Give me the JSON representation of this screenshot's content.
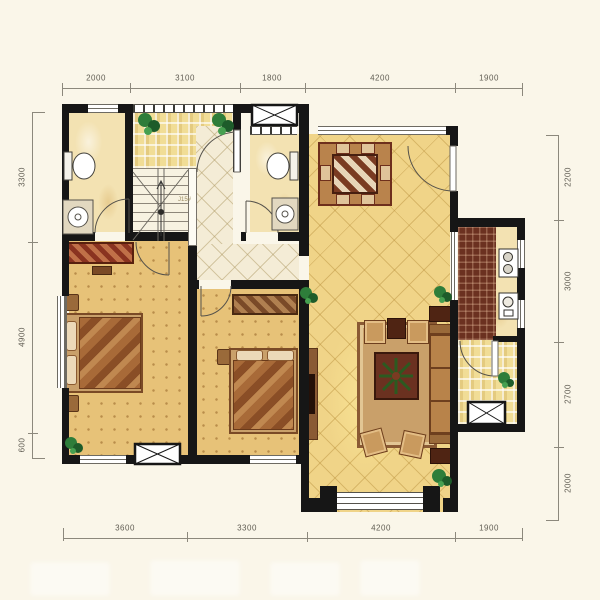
{
  "plan": {
    "dims_top": [
      "2000",
      "3100",
      "1800",
      "4200",
      "1900"
    ],
    "dims_bottom": [
      "3600",
      "3300",
      "4200",
      "1900"
    ],
    "dims_left": [
      "3300",
      "4900",
      "600"
    ],
    "dims_right": [
      "2200",
      "3000",
      "2700",
      "2000"
    ],
    "stair_label": "J15#",
    "colors": {
      "wall": "#161616",
      "floor_living_tile": "#f0d488",
      "floor_bedroom": "#e7c278",
      "floor_bath": "#f3e2b2",
      "floor_hall": "#f4ecd6",
      "balcony_check": "#f1dd96",
      "kitchen_counter": "#6b3120",
      "plant_green": "#2e7d3a",
      "background": "#faf6e9"
    }
  }
}
